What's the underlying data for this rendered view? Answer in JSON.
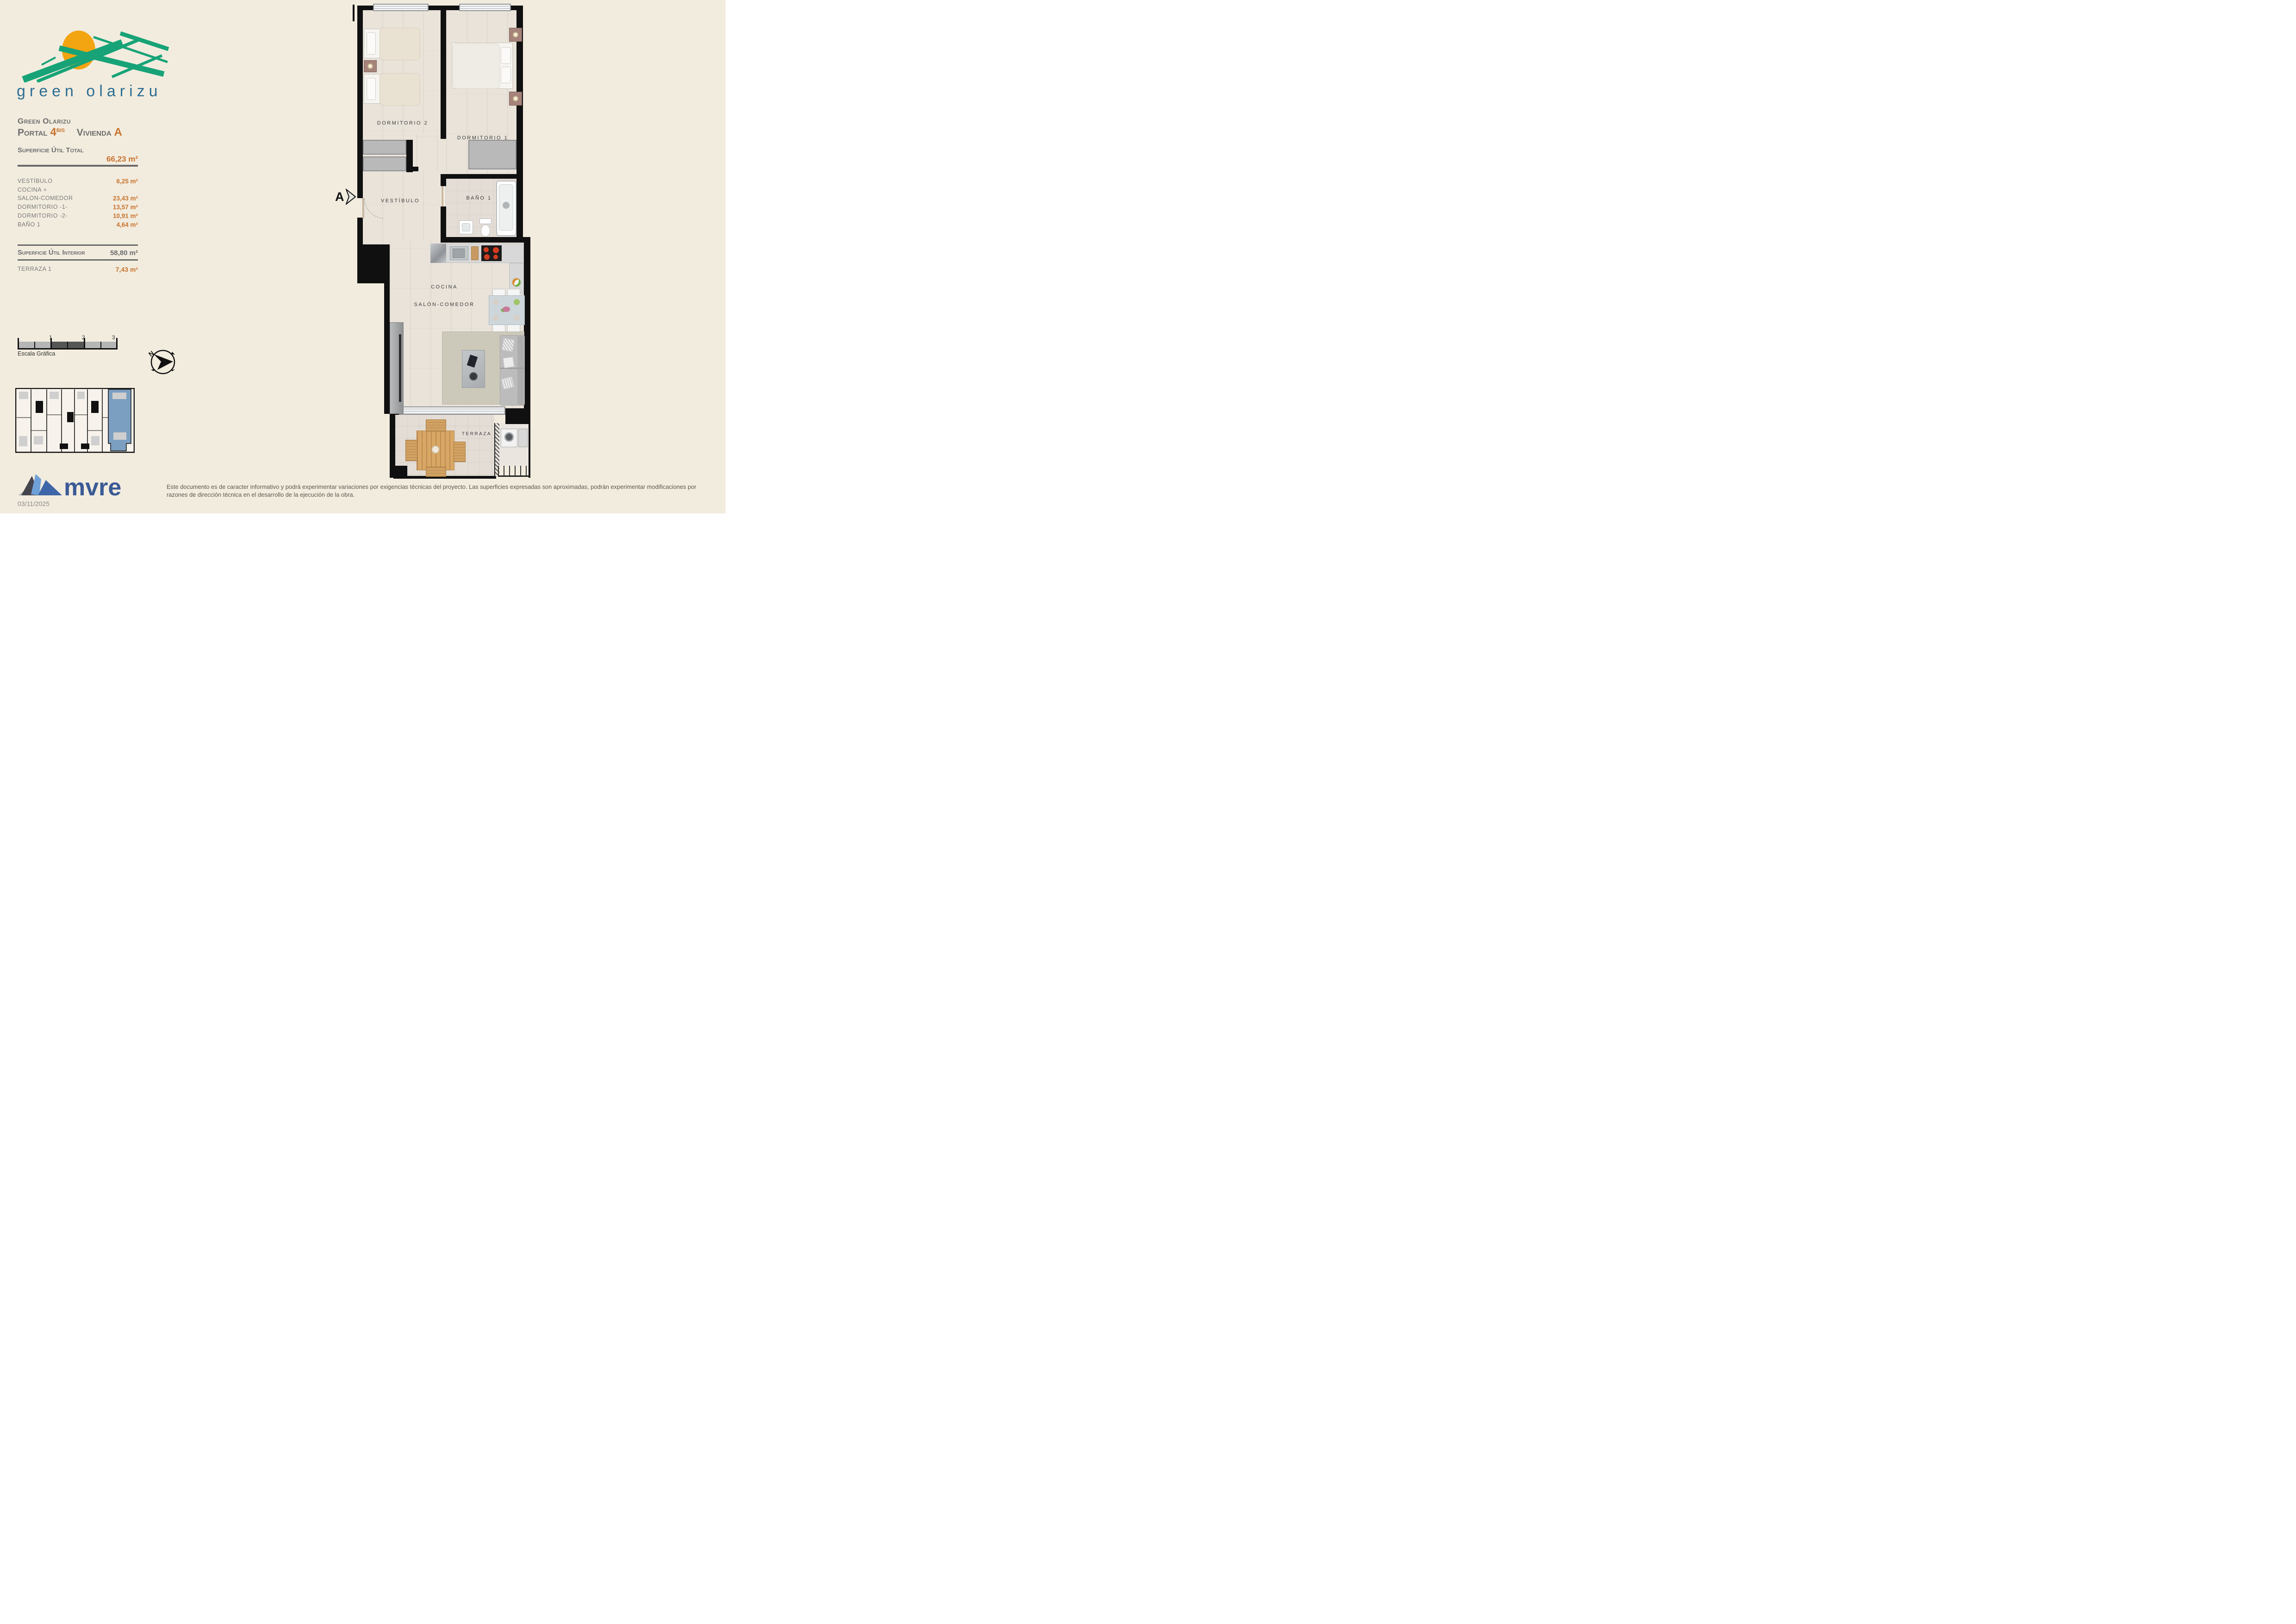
{
  "branding": {
    "logo_text": "green olarizu",
    "colors": {
      "logo_green": "#17a377",
      "logo_sun": "#f3a411",
      "logo_text_blue": "#2d6e92"
    }
  },
  "title_block": {
    "project": "Green Olarizu",
    "portal_label": "Portal",
    "portal_number": "4",
    "portal_suffix": "BIS",
    "vivienda_label": "Vivienda",
    "vivienda_letter": "A",
    "total_label": "Superficie Útil Total",
    "total_value": "66,23 m²",
    "rooms": [
      {
        "name": "VESTÍBULO",
        "area": "6,25 m²"
      },
      {
        "name": "COCINA +",
        "area": ""
      },
      {
        "name": "SALON-COMEDOR",
        "area": "23,43 m²"
      },
      {
        "name": "DORMITORIO -1-",
        "area": "13,57 m²"
      },
      {
        "name": "DORMITORIO -2-",
        "area": "10,91 m²"
      },
      {
        "name": "BAÑO 1",
        "area": "4,64 m²"
      }
    ],
    "interior_label": "Superficie Útil Interior",
    "interior_value": "58,80 m²",
    "terrace_label": "TERRAZA 1",
    "terrace_value": "7,43 m²"
  },
  "scale_bar": {
    "tick_labels": [
      "1",
      "2",
      "3 m."
    ],
    "caption": "Escala Gráfica"
  },
  "compass": {
    "north_label": "N"
  },
  "plan": {
    "section_label": "A",
    "labels": {
      "dormitorio2": "DORMITORIO 2",
      "dormitorio1": "DORMITORIO 1",
      "vestibulo": "VESTÍBULO",
      "bano1": "BAÑO 1",
      "cocina": "COCINA",
      "salon_comedor": "SALÓN-COMEDOR",
      "terraza": "TERRAZA"
    },
    "keyplan_highlight_color": "#7b9fc0"
  },
  "footer": {
    "brand": "mvre",
    "brand_color": "#3b5a96",
    "date": "03/11/2025",
    "disclaimer_line1": "Este documento es de caracter informativo y podrá experimentar variaciones por exigencias técnicas del proyecto. Las superficies expresadas son aproximadas, podrán experimentar modificaciones por",
    "disclaimer_line2": "razones de dirección técnica en el desarrollo de la ejecución de la obra."
  },
  "theme": {
    "background": "#f2ecdf",
    "accent_orange": "#c8732e",
    "heading_gray": "#6d6d6d",
    "wall_black": "#101010"
  }
}
